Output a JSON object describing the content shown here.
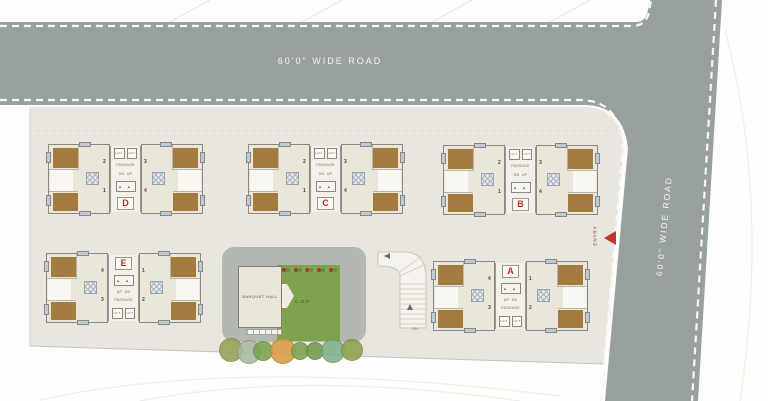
{
  "scene_title": "Residential Site Plan",
  "roads": {
    "top_label": "60'0\" WIDE ROAD",
    "right_label": "60'0\" WIDE ROAD"
  },
  "entry_label": "ENTRY",
  "watermark": "Housing",
  "core_labels": {
    "lift": "LIFT",
    "passage": "PASSAGE",
    "dn_up": "DN  UP",
    "up_dn": "UP  DN",
    "stair": "▲ ▲"
  },
  "amenities": {
    "banquet_hall": "BANQUET HALL",
    "lawn": "C.O.P",
    "walkway_dn": "DN"
  },
  "buildings": [
    {
      "id": "d",
      "label": "D",
      "variant": "top",
      "x": 48,
      "y": 144,
      "units": {
        "tl": "2",
        "tr": "3",
        "bl": "1",
        "br": "4"
      }
    },
    {
      "id": "c",
      "label": "C",
      "variant": "top",
      "x": 248,
      "y": 144,
      "units": {
        "tl": "2",
        "tr": "3",
        "bl": "1",
        "br": "4"
      }
    },
    {
      "id": "b",
      "label": "B",
      "variant": "top",
      "x": 443,
      "y": 145,
      "units": {
        "tl": "2",
        "tr": "3",
        "bl": "1",
        "br": "4"
      }
    },
    {
      "id": "e",
      "label": "E",
      "variant": "bottom",
      "x": 46,
      "y": 253,
      "units": {
        "tl": "4",
        "tr": "1",
        "bl": "3",
        "br": "2"
      }
    },
    {
      "id": "a",
      "label": "A",
      "variant": "bottom",
      "x": 433,
      "y": 261,
      "units": {
        "tl": "4",
        "tr": "1",
        "bl": "3",
        "br": "2"
      }
    }
  ],
  "trees": [
    {
      "x": 231,
      "y": 350,
      "r": 12,
      "color": "#95a355"
    },
    {
      "x": 249,
      "y": 352,
      "r": 12,
      "color": "#a9b8a2"
    },
    {
      "x": 263,
      "y": 351,
      "r": 10,
      "color": "#79a44e"
    },
    {
      "x": 283,
      "y": 351,
      "r": 13,
      "color": "#d79c42"
    },
    {
      "x": 300,
      "y": 351,
      "r": 9,
      "color": "#79a44e"
    },
    {
      "x": 315,
      "y": 351,
      "r": 9,
      "color": "#6f9d49"
    },
    {
      "x": 333,
      "y": 351,
      "r": 12,
      "color": "#7fb08d"
    },
    {
      "x": 352,
      "y": 350,
      "r": 11,
      "color": "#8ba24e"
    }
  ],
  "flowers": {
    "y": 268,
    "start_x": 282,
    "step": 3.9,
    "count": 14,
    "colors": [
      "#a93a2e",
      "#5f913f",
      "#7fae4a"
    ]
  },
  "colors": {
    "road": "#99a19e",
    "road_dash": "#f6f6f4",
    "site": "#e9e6df",
    "building_fill": "#ebe6da",
    "brown_room": "#a57c3f",
    "pad": "#b4b8b2",
    "lawn": "#7fa24d",
    "label_red": "#c92f26",
    "entry_red": "#bf3a2b"
  }
}
